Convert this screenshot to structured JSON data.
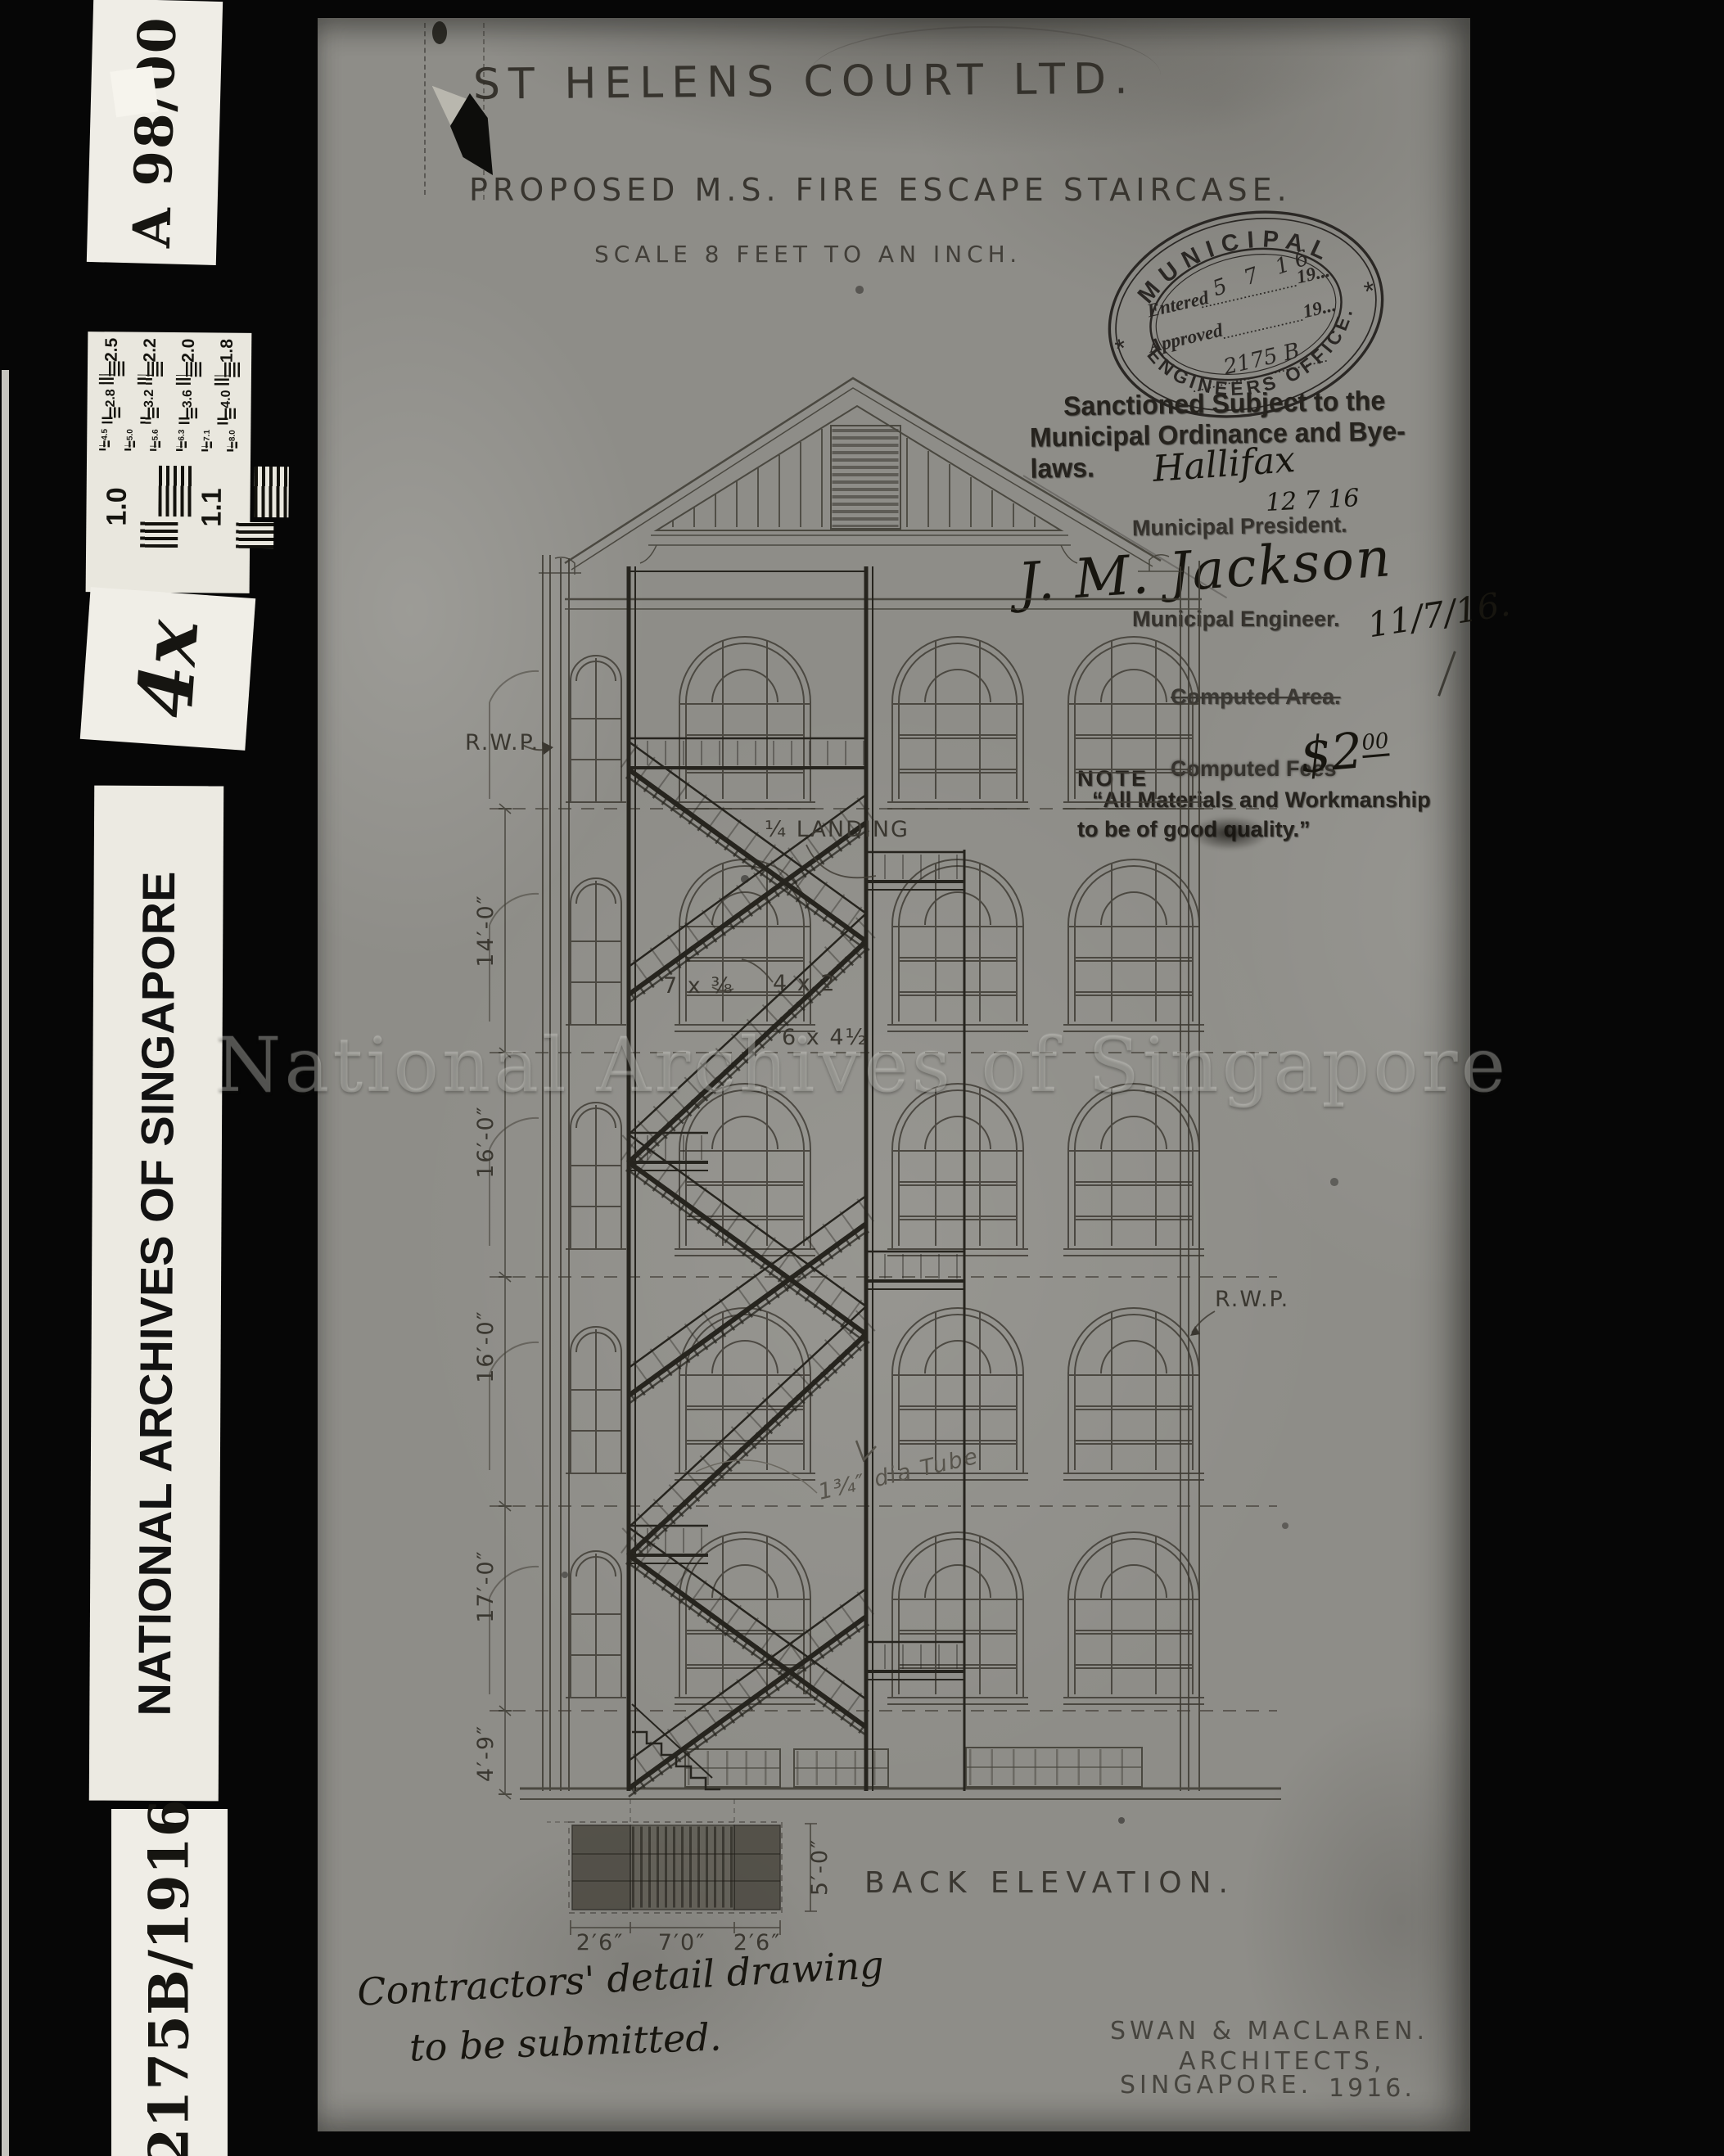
{
  "colors": {
    "film_background": "#060606",
    "label_background": "#efede6",
    "paper": "#8e8d88",
    "ink": "#26231e"
  },
  "watermark": "National Archives of Singapore",
  "film_strip": {
    "top_label": "A 98/00",
    "magnification_label": "4x",
    "archive_label": "NATIONAL ARCHIVES OF SINGAPORE",
    "reference_label": "2175B/1916",
    "test_chart": {
      "row1": [
        "2.5",
        "2.2",
        "2.0",
        "1.8"
      ],
      "row2": [
        "2.8",
        "3.2",
        "3.6",
        "4.0"
      ],
      "row3": [
        "4.5",
        "5.0",
        "5.6",
        "6.3",
        "7.1",
        "8.0"
      ],
      "large": [
        "1.0",
        "1.1"
      ]
    }
  },
  "document": {
    "title": "ST HELENS COURT LTD.",
    "subtitle": "PROPOSED M.S. FIRE ESCAPE STAIRCASE.",
    "scale_note": "SCALE 8 FEET TO AN INCH.",
    "stamp": {
      "arc_top": "MUNICIPAL",
      "arc_bottom": "ENGINEERS OFFICE.",
      "asterisk": "*",
      "entered_label": "Entered",
      "entered_year": "19...",
      "entered_value": "5 7 16",
      "approved_label": "Approved",
      "approved_year": "19...",
      "file_number": "2175 B"
    },
    "sanction_line1": "Sanctioned Subject to the",
    "sanction_line2": "Municipal Ordinance and Bye-laws.",
    "president_signature": "Hallifax",
    "president_date": "12 7 16",
    "president_title": "Municipal President.",
    "engineer_signature": "J. M. Jackson",
    "engineer_title": "Municipal Engineer.",
    "engineer_date": "11/7/16.",
    "computed_area_label": "Computed Area.",
    "computed_fees_label": "Computed Fees",
    "fees_value_main": "$2",
    "fees_value_sup": "00",
    "note_heading": "NOTE",
    "note_line1": "“All Materials and Workmanship",
    "note_line2": "to be of good quality.”",
    "drawing": {
      "caption": "BACK ELEVATION.",
      "rwp_left": "R.W.P.",
      "rwp_right": "R.W.P.",
      "quarter_landing": "¼ LANDING",
      "size_a": "7 x ⅜",
      "size_b": "4 x 2",
      "size_c": "6 x 4½",
      "tube_note": "1¾″ dia Tube",
      "dims": {
        "d14": "14′-0″",
        "d16a": "16′-0″",
        "d16b": "16′-0″",
        "d17": "17′-0″",
        "d49": "4′-9″",
        "p26a": "2′6″",
        "p70": "7′0″",
        "p26b": "2′6″",
        "p50": "5′-0″"
      }
    },
    "contractor_note_line1": "Contractors' detail drawing",
    "contractor_note_line2": "to be submitted.",
    "architect_line1": "SWAN & MACLAREN.",
    "architect_line2": "ARCHITECTS,",
    "architect_line3": "SINGAPORE.",
    "architect_year": "1916."
  }
}
